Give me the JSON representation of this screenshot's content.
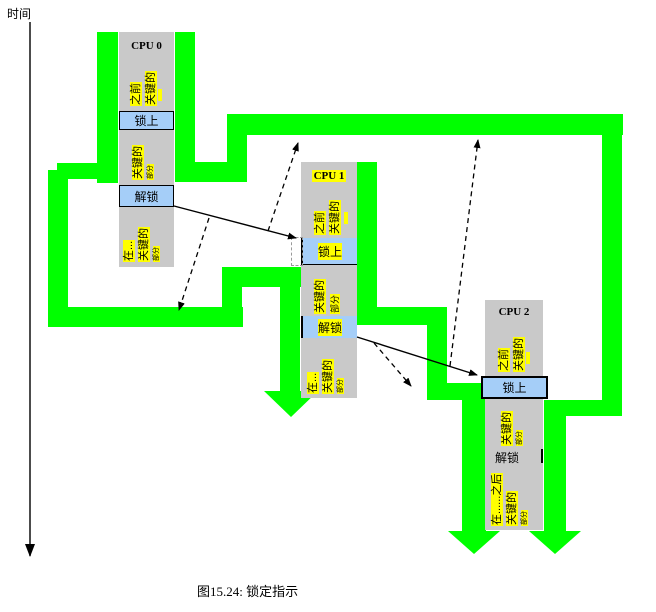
{
  "time_axis": {
    "label": "时间"
  },
  "caption": "图15.24: 锁定指示",
  "colors": {
    "path_green": "#00ff00",
    "cpu_column_gray": "#c9c9c9",
    "lock_box_blue": "#a5cef8",
    "highlight_yellow": "#ffff00"
  },
  "cpus": [
    {
      "title": "CPU 0",
      "prior_section": {
        "line1": "之前",
        "line2": "关键的"
      },
      "lock_label": "锁上",
      "critical_section": {
        "line1": "关键的",
        "line2": "部分"
      },
      "unlock_label": "解锁",
      "after_section": {
        "line1": "在...",
        "line2": "关键的",
        "line3": "部分"
      }
    },
    {
      "title": "CPU 1",
      "prior_section": {
        "line1": "之前",
        "line2": "关键的"
      },
      "lock_label": "锁上",
      "critical_section": {
        "line1": "关键的",
        "line2": "部分"
      },
      "unlock_label": "解锁",
      "after_section": {
        "line1": "在...",
        "line2": "关键的",
        "line3": "部分"
      }
    },
    {
      "title": "CPU 2",
      "prior_section": {
        "line1": "之前",
        "line2": "关键的"
      },
      "lock_label": "锁上",
      "critical_section": {
        "line1": "关键的",
        "line2": "部分"
      },
      "unlock_label": "解锁",
      "after_section": {
        "line1": "在......之后",
        "line2": "关键的",
        "line3": "部分"
      }
    }
  ]
}
